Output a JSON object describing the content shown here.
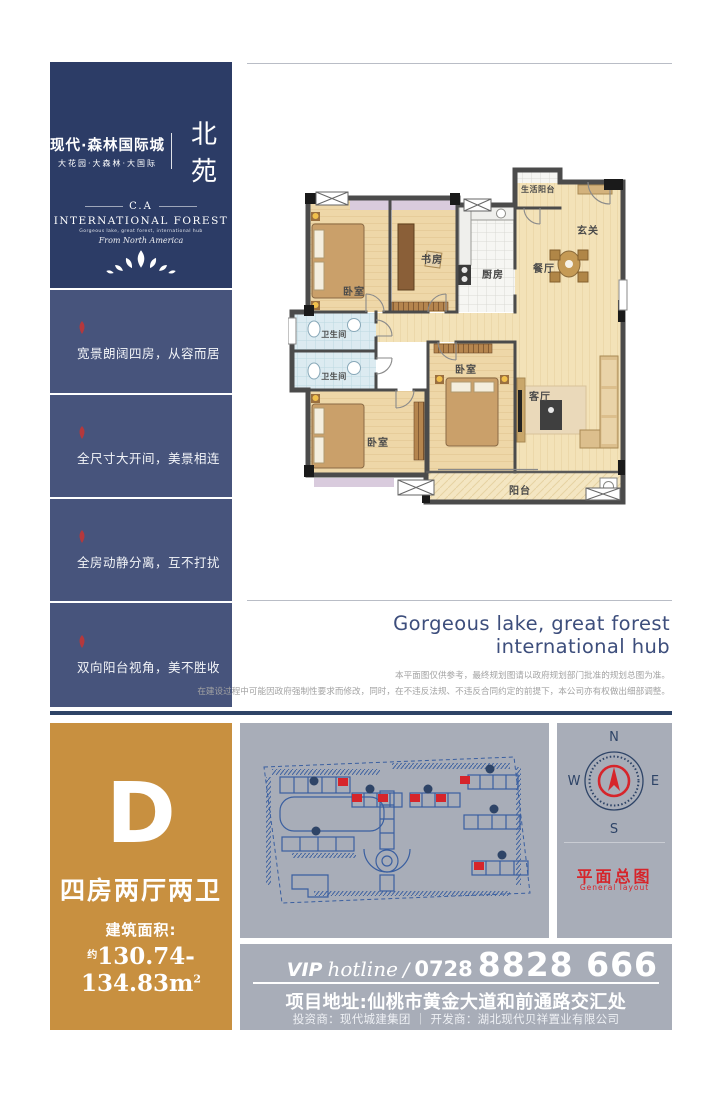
{
  "brand": {
    "name_cn": "现代·森林国际城",
    "tagline_cn": "大花园·大森林·大国际",
    "section_cn": "北苑",
    "logo_abbr": "C.A",
    "logo_en": "INTERNATIONAL FOREST",
    "logo_sub": "Gorgeous lake, great forest, international hub",
    "logo_script": "From North America"
  },
  "selling_points": [
    {
      "text": "宽景朗阔四房，从容而居"
    },
    {
      "text": "全尺寸大开间，美景相连"
    },
    {
      "text": "全房动静分离，互不打扰"
    },
    {
      "text": "双向阳台视角，美不胜收"
    }
  ],
  "floor_plan": {
    "rooms": {
      "service_balcony": "生活阳台",
      "entry": "玄关",
      "dining": "餐厅",
      "kitchen": "厨房",
      "study": "书房",
      "bedroom_a": "卧室",
      "bedroom_b": "卧室",
      "bedroom_c": "卧室",
      "bath_a": "卫生间",
      "bath_b": "卫生间",
      "living": "客厅",
      "balcony": "阳台"
    }
  },
  "tagline": {
    "line1": "Gorgeous lake, great forest",
    "line2": "international hub"
  },
  "disclaimer": {
    "line1": "本平面图仅供参考，最终规划图请以政府规划部门批准的规划总图为准。",
    "line2": "在建设过程中可能因政府强制性要求而修改，同时，在不违反法规、不违反合同约定的前提下，本公司亦有权做出细部调整。"
  },
  "unit": {
    "type": "D",
    "layout": "四房两厅两卫",
    "area_label": "建筑面积:",
    "area_prefix": "约",
    "area_value": "130.74-134.83m",
    "area_sup": "2"
  },
  "site_plan": {
    "title": "平面总图",
    "subtitle": "General layout"
  },
  "compass": {
    "n": "N",
    "e": "E",
    "s": "S",
    "w": "W"
  },
  "hotline": {
    "vip": "VIP",
    "script": "hotline",
    "slash": "/",
    "prefix": "0728",
    "number": "8828 666"
  },
  "footer": {
    "address": "项目地址:仙桃市黄金大道和前通路交汇处",
    "companies": "投资商：现代城建集团 ｜ 开发商：湖北现代贝祥置业有限公司"
  },
  "colors": {
    "navy": "#2c3c66",
    "sidebar_navy": "#47547c",
    "divider_navy": "#2e4467",
    "orange": "#c89040",
    "panel_gray": "#a8adb8",
    "accent_red": "#d6252b",
    "plan_blue": "#3a5fa0",
    "tagline_blue": "#3d4e7c"
  }
}
